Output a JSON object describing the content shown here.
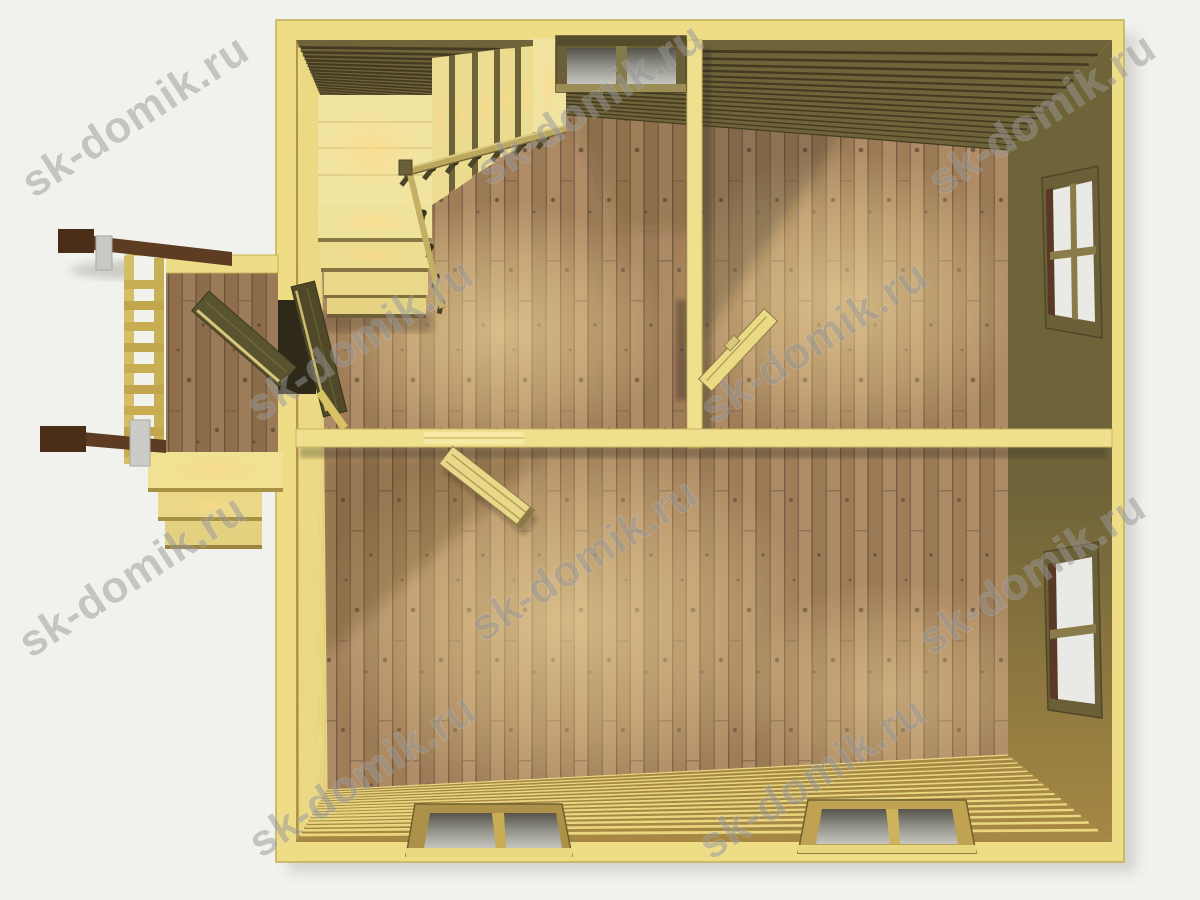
{
  "scene": {
    "kind": "3d-architectural-render",
    "subject": "top-down interior view of first floor of a timber house",
    "rooms_visible": 3,
    "site_watermark": "sk-domik.ru"
  },
  "watermark": {
    "text": "sk-domik.ru",
    "angle_deg": -33,
    "font_size": 44,
    "opacity": 0.5,
    "color": "#989898",
    "stroke": "rgba(255,255,255,0.45)",
    "positions": [
      [
        143,
        128
      ],
      [
        598,
        116
      ],
      [
        1050,
        126
      ],
      [
        368,
        352
      ],
      [
        822,
        354
      ],
      [
        140,
        588
      ],
      [
        592,
        572
      ],
      [
        1040,
        585
      ],
      [
        370,
        788
      ],
      [
        820,
        790
      ]
    ]
  },
  "palette": {
    "background": "#f1f1ee",
    "plate": "#eedd85",
    "plate_edge": "#c3ae58",
    "floor_base": "#a8855f",
    "floor_gap": "#6d563e",
    "wall_top_base": "#6e6339",
    "wall_right_base": "#6e6339",
    "wall_bottom_base": "#a68844",
    "wall_left_base": "#b3924a",
    "line_top": "#433a21",
    "line_right": "#4b4226",
    "line_bottom": "#e9d67f",
    "line_left": "#ecd984",
    "partition": "#efe08d",
    "stair_pale": "#f1e4a0",
    "rail_dark": "#5d3c22",
    "glass_gray": "#c7c7c3",
    "glass_white": "#e9e9e5",
    "window_frame_olive": "#6a5f37",
    "window_jamb_brown": "#5a3826"
  },
  "walls": {
    "line_count": 16,
    "perspective_pow": 0.72,
    "corners": {
      "tl": {
        "out": [
          296,
          40
        ],
        "in": [
          320,
          95
        ]
      },
      "tr": {
        "out": [
          1112,
          40
        ],
        "in": [
          1008,
          150
        ]
      },
      "br": {
        "out": [
          1112,
          842
        ],
        "in": [
          1008,
          755
        ]
      },
      "bl": {
        "out": [
          296,
          842
        ],
        "in": [
          327,
          790
        ]
      }
    }
  },
  "house": {
    "windows": [
      {
        "id": "top-wall-window",
        "panes": 2
      },
      {
        "id": "right-wall-upper-window",
        "panes": 4
      },
      {
        "id": "right-wall-lower-window",
        "panes": 2
      },
      {
        "id": "bottom-wall-left-window",
        "panes": 2
      },
      {
        "id": "bottom-wall-right-window",
        "panes": 2
      }
    ],
    "doors_open": [
      "entrance-door",
      "hall-to-lower-room-door",
      "hall-to-upper-right-room-door"
    ],
    "staircase": {
      "flights": 2,
      "lower_treads": 4,
      "upper_treads": 6,
      "railings": 2
    },
    "porch": {
      "steps": 3,
      "dark_handrails": 2,
      "railing_rungs": 9
    }
  }
}
